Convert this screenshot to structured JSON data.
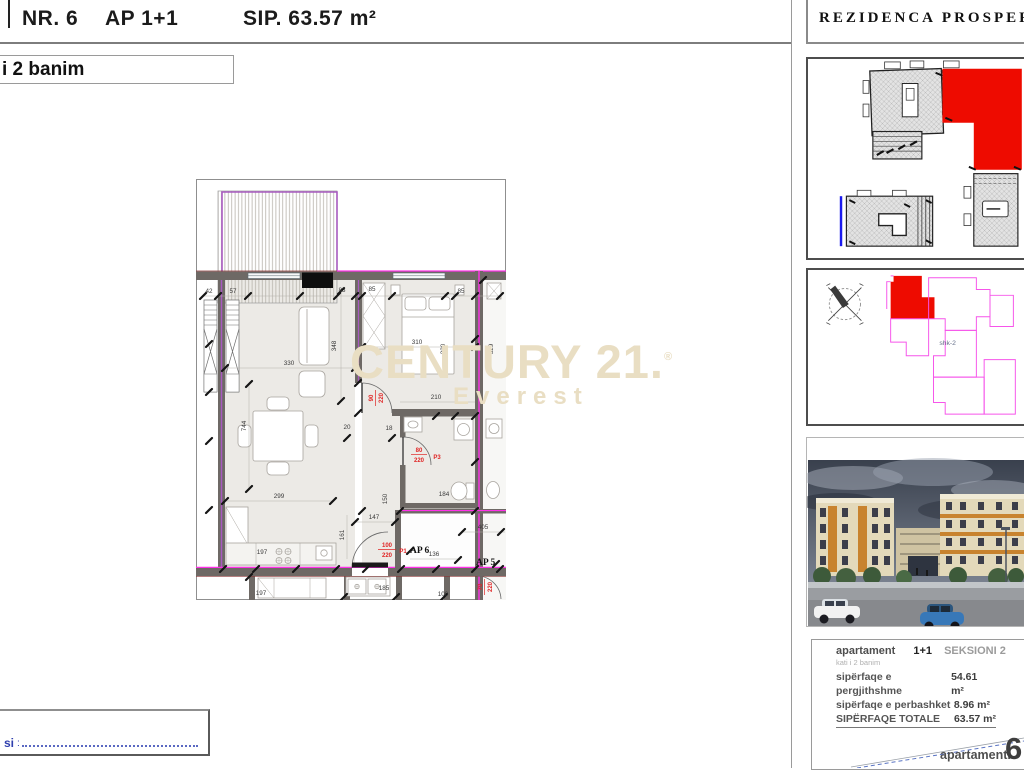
{
  "header": {
    "nr": "NR. 6",
    "ap": "AP 1+1",
    "sip": "SIP. 63.57 m²",
    "floor_box": "i 2 banim"
  },
  "watermark": {
    "brand": "CENTURY 21.",
    "reg": "®",
    "sub": "Everest"
  },
  "sidebar": {
    "title": "REZIDENCA PROSPER",
    "keyplan_label": "shk-2",
    "info": {
      "apartament_label": "apartament",
      "type": "1+1",
      "section": "SEKSIONI 2",
      "floor_note": "kati i 2 banim",
      "rows": [
        {
          "label": "sipërfaqe e pergjithshme",
          "value": "54.61 m²"
        },
        {
          "label": "sipërfaqe e perbashket",
          "value": "8.96 m²"
        },
        {
          "label": "SIPËRFAQE  TOTALE",
          "value": "63.57 m²"
        }
      ],
      "apt_word": "apartamenti",
      "apt_num": "6"
    }
  },
  "plan": {
    "ap6": "AP 6",
    "ap5": "AP 5",
    "dims": {
      "a42": "42",
      "a57": "57",
      "a83": "83",
      "a85a": "85",
      "a85b": "85",
      "a330": "330",
      "a348": "348",
      "a310": "310",
      "a320": "320",
      "a329": "329",
      "a210": "210",
      "a744": "744",
      "a20": "20",
      "a18": "18",
      "a299": "299",
      "a147": "147",
      "a150": "150",
      "a161": "161",
      "a184": "184",
      "a405": "405",
      "a136": "136",
      "a100": "100",
      "a185": "185",
      "a197a": "197",
      "a197b": "197"
    },
    "doors": {
      "d90a": "90",
      "d90b": "220",
      "d80a": "80",
      "d80b": "220",
      "p3": "P3",
      "d100a": "100",
      "d100b": "220",
      "p1": "P1",
      "d70a": "70",
      "d70b": "220"
    }
  },
  "footer": {
    "label": "si",
    "colon": ":"
  }
}
